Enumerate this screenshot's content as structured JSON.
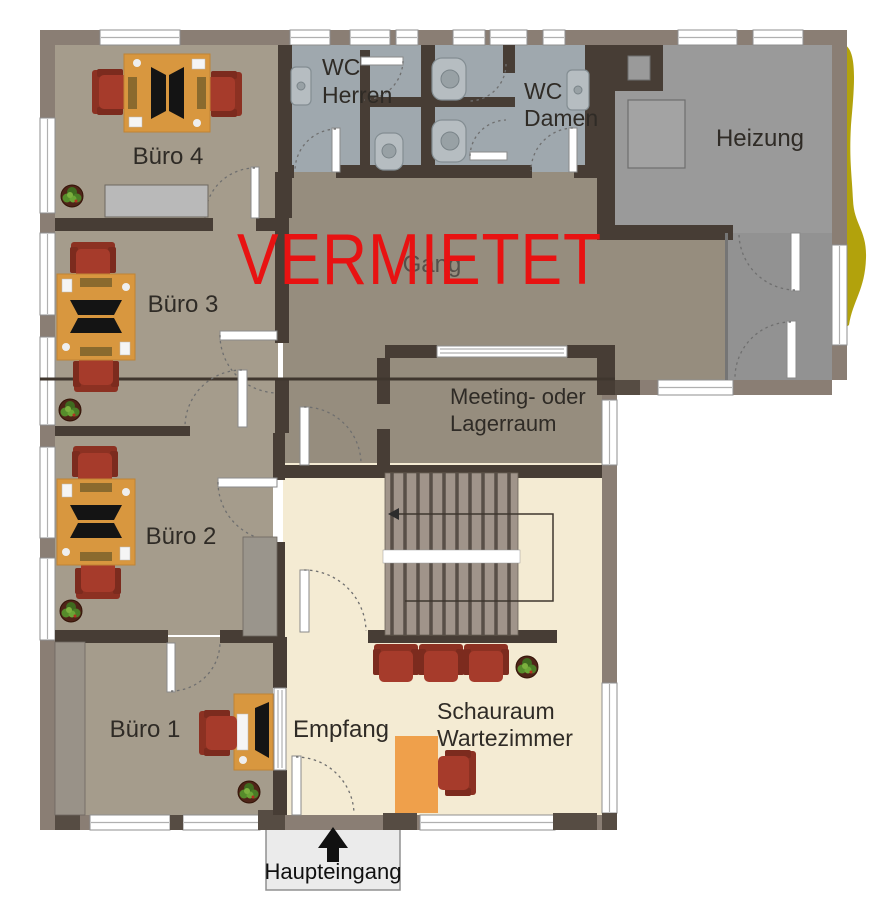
{
  "floorplan": {
    "status_overlay": {
      "label": "VERMIETET",
      "color": "#e81212"
    },
    "rooms": {
      "buero4": {
        "label": "Büro 4"
      },
      "buero3": {
        "label": "Büro 3"
      },
      "buero2": {
        "label": "Büro 2"
      },
      "buero1": {
        "label": "Büro 1"
      },
      "wc_herren": {
        "line1": "WC",
        "line2": "Herren"
      },
      "wc_damen": {
        "line1": "WC",
        "line2": "Damen"
      },
      "heizung": {
        "label": "Heizung"
      },
      "gang": {
        "label": "Gang"
      },
      "meeting": {
        "line1": "Meeting- oder",
        "line2": "Lagerraum"
      },
      "empfang": {
        "label": "Empfang"
      },
      "schauraum": {
        "line1": "Schauraum",
        "line2": "Wartezimmer"
      }
    },
    "entrance": {
      "label": "Haupteingang"
    },
    "colors": {
      "outer_wall": "#8a7e74",
      "inner_wall": "#473d35",
      "office_floor": "#a59c8c",
      "corridor_floor": "#968d7e",
      "wc_floor": "#9fa8ae",
      "heizung_floor": "#9a9a9a",
      "vestibule_floor": "#929292",
      "hall_floor": "#f4ebd3",
      "stairs": "#a0948a",
      "desk": "#d8973f",
      "reception_desk": "#efa04b",
      "chair": "#a63b2b",
      "plant": "#4a7d26",
      "status_red": "#e81212",
      "hedge": "#b2a20c",
      "entrance_box": "#ebebeb"
    }
  }
}
